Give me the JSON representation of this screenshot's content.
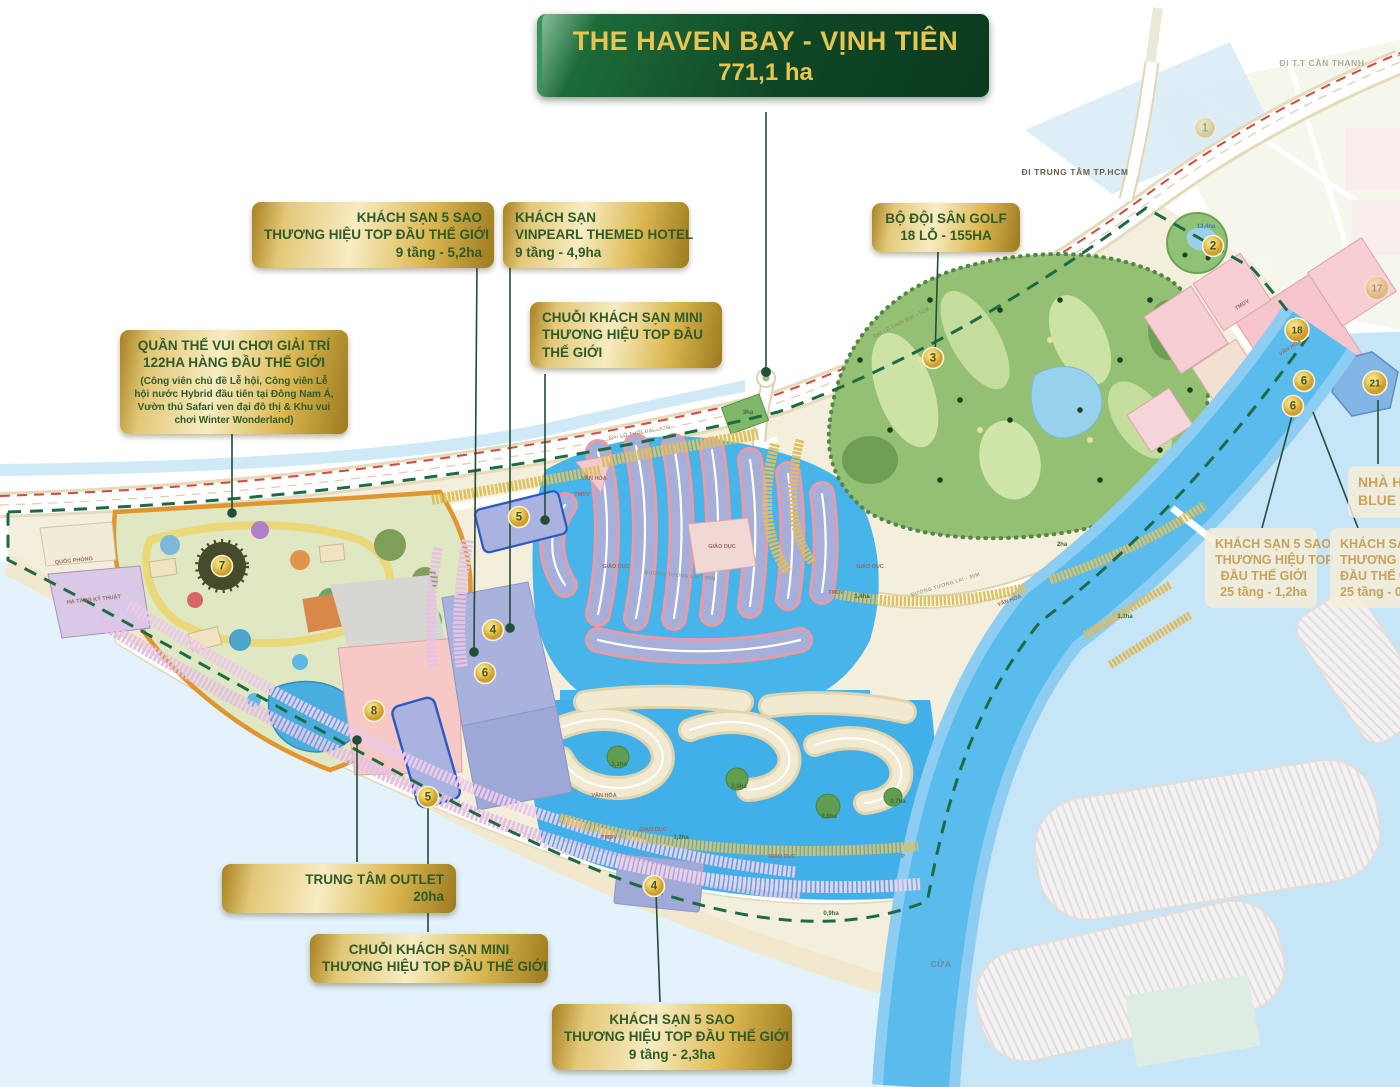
{
  "title": {
    "line1": "THE HAVEN BAY - VỊNH TIÊN",
    "line2": "771,1 ha"
  },
  "colors": {
    "title_green": "#0f4726",
    "title_gold_text": "#e7c554",
    "callout_gold": "#dcb852",
    "callout_text_green": "#2e5b2a",
    "cream_callout_text": "#c9a25b",
    "canal_water": "#47b4ea",
    "bay_water": "#c6e5f6",
    "river": "#5abced",
    "land_cream": "#f4efdc",
    "golf_green": "#94c073",
    "boundary_dash_green": "#1d6b45",
    "badge_gold": "#eccf62",
    "marina_block_purple": "#a6aeda",
    "townhouse_pink": "#e6c0e4",
    "block_pink": "#f5c5cb",
    "hotel_block_blue": "#aab3e0"
  },
  "callouts": {
    "hotel_5sao_52": {
      "line1": "KHÁCH SẠN 5 SAO",
      "line2": "THƯƠNG HIỆU TOP ĐẦU THẾ GIỚI",
      "line3": "9 tầng - 5,2ha"
    },
    "vinpearl": {
      "line1": "KHÁCH SẠN",
      "line2": "VINPEARL THEMED HOTEL",
      "line3": "9 tầng - 4,9ha"
    },
    "mini_top": {
      "line1": "CHUỖI KHÁCH SẠN MINI",
      "line2": "THƯƠNG HIỆU TOP ĐẦU",
      "line3": "THẾ GIỚI"
    },
    "golf": {
      "line1": "BỘ ĐỘI SÂN GOLF",
      "line2": "18 LỖ - 155HA"
    },
    "theme_park": {
      "line1": "QUẦN THỂ VUI CHƠI GIẢI TRÍ",
      "line2": "122HA HÀNG ĐẦU  THẾ GIỚI",
      "note": "(Công viên chủ đề Lễ hội, Công viên Lễ hội nước Hybrid đầu tiên tại Đông Nam Á, Vườn thú Safari ven đại đô thị & Khu vui chơi Winter Wonderland)"
    },
    "outlet": {
      "line1": "TRUNG TÂM OUTLET",
      "line2": "20ha"
    },
    "mini_bottom": {
      "line1": "CHUỖI KHÁCH SẠN MINI",
      "line2": "THƯƠNG HIỆU TOP ĐẦU THẾ GIỚI"
    },
    "hotel_5sao_23": {
      "line1": "KHÁCH SẠN 5 SAO",
      "line2": "THƯƠNG HIỆU TOP ĐẦU THẾ GIỚI",
      "line3": "9 tầng - 2,3ha"
    },
    "hotel_25t_12": {
      "line1": "KHÁCH SẠN 5 SAO",
      "line2": "THƯƠNG HIỆU TOP",
      "line3": "ĐẦU THẾ GIỚI",
      "line4": "25 tầng - 1,2ha"
    },
    "hotel_25t_09": {
      "line1": "KHÁCH SẠN 5 SAO",
      "line2": "THƯƠNG HIỆU TO",
      "line3": "ĐẦU THẾ GIỚI",
      "line4": "25 tầng - 0,9ha"
    },
    "blue_w": {
      "line1": "NHÀ H",
      "line2": "BLUE W"
    }
  },
  "map": {
    "badges": [
      {
        "n": "1",
        "x": 1205,
        "y": 128,
        "faded": true
      },
      {
        "n": "2",
        "x": 1213,
        "y": 246,
        "faded": false
      },
      {
        "n": "3",
        "x": 933,
        "y": 358,
        "faded": false
      },
      {
        "n": "5",
        "x": 519,
        "y": 517,
        "faded": false
      },
      {
        "n": "4",
        "x": 493,
        "y": 630,
        "faded": false
      },
      {
        "n": "6",
        "x": 485,
        "y": 673,
        "faded": false
      },
      {
        "n": "7",
        "x": 222,
        "y": 566,
        "faded": false
      },
      {
        "n": "8",
        "x": 374,
        "y": 711,
        "faded": false
      },
      {
        "n": "5",
        "x": 428,
        "y": 797,
        "faded": false
      },
      {
        "n": "4",
        "x": 654,
        "y": 886,
        "faded": false
      },
      {
        "n": "17",
        "x": 1377,
        "y": 288,
        "faded": true
      },
      {
        "n": "18",
        "x": 1297,
        "y": 330,
        "faded": false
      },
      {
        "n": "6",
        "x": 1304,
        "y": 381,
        "faded": false
      },
      {
        "n": "6",
        "x": 1293,
        "y": 406,
        "faded": false
      },
      {
        "n": "21",
        "x": 1375,
        "y": 383,
        "faded": false
      }
    ],
    "labels": [
      {
        "t": "ĐI TRUNG TÂM TP.HCM",
        "x": 1075,
        "y": 175,
        "c": "dir",
        "r": 0
      },
      {
        "t": "ĐI T.T CẦN THẠNH",
        "x": 1322,
        "y": 66,
        "c": "dir faded",
        "r": 0
      },
      {
        "t": "CỬA",
        "x": 941,
        "y": 967,
        "c": "dir faded",
        "r": 0
      },
      {
        "t": "ĐẠI LỘ THỜI ĐẠI - 52M",
        "x": 640,
        "y": 434,
        "c": "road",
        "r": -10
      },
      {
        "t": "ĐẠI LỘ THỜI ĐẠI - 52M",
        "x": 902,
        "y": 324,
        "c": "road",
        "r": -27
      },
      {
        "t": "ĐƯỜNG TƯƠNG LAI - 36M",
        "x": 680,
        "y": 577,
        "c": "road",
        "r": 5
      },
      {
        "t": "ĐƯỜNG TƯƠNG LAI - 30M",
        "x": 946,
        "y": 586,
        "c": "road",
        "r": -17
      },
      {
        "t": "QUỐC PHÒNG",
        "x": 74,
        "y": 562,
        "c": "area",
        "r": -6
      },
      {
        "t": "HẠ TẦNG KỸ THUẬT",
        "x": 94,
        "y": 601,
        "c": "area",
        "r": -6
      },
      {
        "t": "VĂN HÓA",
        "x": 594,
        "y": 480,
        "c": "area",
        "r": 0
      },
      {
        "t": "TMDV",
        "x": 582,
        "y": 496,
        "c": "area",
        "r": 0
      },
      {
        "t": "GIÁO DỤC",
        "x": 722,
        "y": 548,
        "c": "area",
        "r": 0
      },
      {
        "t": "GIÁO DỤC",
        "x": 616,
        "y": 568,
        "c": "area",
        "r": 0
      },
      {
        "t": "TMDV",
        "x": 836,
        "y": 594,
        "c": "area",
        "r": 0
      },
      {
        "t": "GIÁO DỤC",
        "x": 870,
        "y": 568,
        "c": "area",
        "r": 0
      },
      {
        "t": "1,4ha",
        "x": 862,
        "y": 598,
        "c": "ha",
        "r": 0
      },
      {
        "t": "3ha",
        "x": 748,
        "y": 414,
        "c": "ha",
        "r": 0
      },
      {
        "t": "13,4ha",
        "x": 1206,
        "y": 228,
        "c": "ha blue",
        "r": 0
      },
      {
        "t": "VĂN HÓA",
        "x": 1291,
        "y": 349,
        "c": "area",
        "r": -33
      },
      {
        "t": "TMDV",
        "x": 1243,
        "y": 306,
        "c": "area",
        "r": -33
      },
      {
        "t": "2ha",
        "x": 1062,
        "y": 546,
        "c": "ha",
        "r": 0
      },
      {
        "t": "1,1ha",
        "x": 1125,
        "y": 618,
        "c": "ha",
        "r": 0
      },
      {
        "t": "VĂN HÓA",
        "x": 1010,
        "y": 602,
        "c": "area",
        "r": -20
      },
      {
        "t": "1,1ha",
        "x": 619,
        "y": 766,
        "c": "ha",
        "r": 0
      },
      {
        "t": "VĂN HÓA",
        "x": 604,
        "y": 797,
        "c": "area",
        "r": 0
      },
      {
        "t": "0,6ha",
        "x": 739,
        "y": 788,
        "c": "ha",
        "r": 0
      },
      {
        "t": "GIÁO DỤC",
        "x": 653,
        "y": 831,
        "c": "area",
        "r": 0
      },
      {
        "t": "1,2ha",
        "x": 681,
        "y": 839,
        "c": "ha",
        "r": 0
      },
      {
        "t": "TMDV",
        "x": 609,
        "y": 839,
        "c": "area",
        "r": 0
      },
      {
        "t": "0,8ha",
        "x": 829,
        "y": 818,
        "c": "ha",
        "r": 0
      },
      {
        "t": "0,7ha",
        "x": 898,
        "y": 803,
        "c": "ha",
        "r": 0
      },
      {
        "t": "GIÁO DỤC",
        "x": 782,
        "y": 858,
        "c": "area",
        "r": 0
      },
      {
        "t": "0,9ha",
        "x": 831,
        "y": 915,
        "c": "ha",
        "r": 0
      },
      {
        "t": "P",
        "x": 903,
        "y": 858,
        "c": "area",
        "r": 0
      }
    ]
  }
}
